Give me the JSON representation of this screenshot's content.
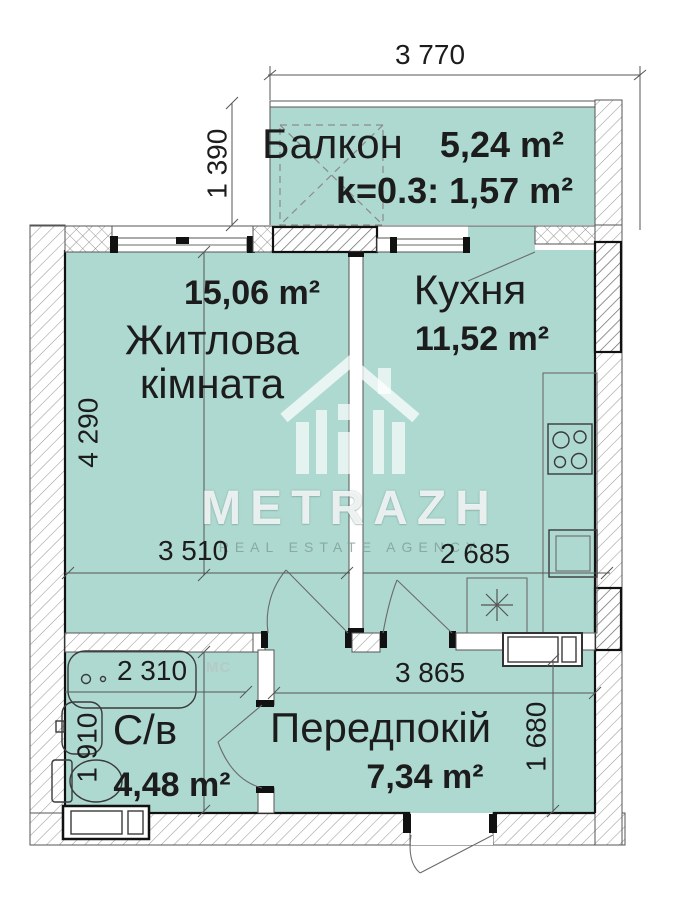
{
  "watermark": {
    "brand": "METRAZH",
    "tagline": "REAL ESTATE AGENCY"
  },
  "rooms": {
    "balcony": {
      "name": "Балкон",
      "area": "5,24 m²",
      "coef": "k=0.3: 1,57 m²"
    },
    "living": {
      "name": "Житлова кімната",
      "area": "15,06 m²"
    },
    "kitchen": {
      "name": "Кухня",
      "area": "11,52 m²"
    },
    "bathroom": {
      "name": "С/в",
      "area": "4,48 m²",
      "appliance_label": "МС"
    },
    "hall": {
      "name": "Передпокій",
      "area": "7,34 m²"
    }
  },
  "dimensions": {
    "top_width": "3 770",
    "balcony_height": "1 390",
    "living_height": "4 290",
    "living_width": "3 510",
    "kitchen_width": "2 685",
    "bathroom_width": "2 310",
    "bathroom_height": "1 910",
    "hall_width": "3 865",
    "hall_height": "1 680"
  },
  "colors": {
    "room_fill": "#aed9d0",
    "wall_line": "#1a1a1a",
    "dim_line": "#555555",
    "text": "#1c1c1c",
    "mc_label": "#b5cac5",
    "watermark_text": "#ffffff",
    "tagline": "#8fb5ad"
  }
}
